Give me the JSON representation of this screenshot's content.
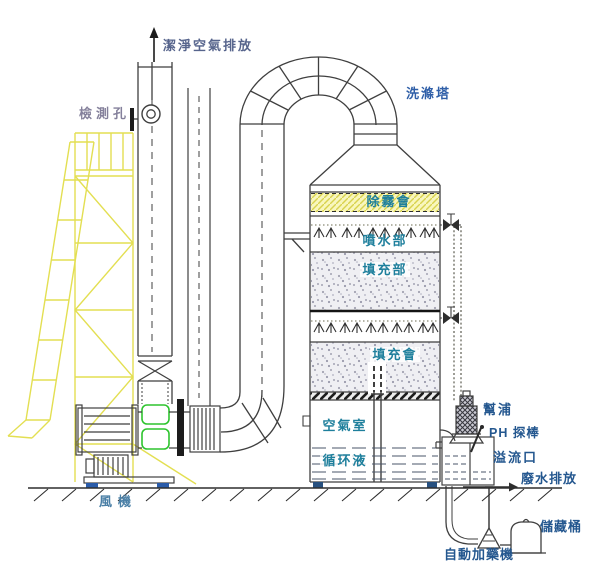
{
  "diagram": {
    "labels": {
      "clean_air": "潔淨空氣排放",
      "test_port": "檢測孔",
      "scrubber_tower": "洗滌塔",
      "demister": "除霧會",
      "spray_section": "噴水部",
      "packing_upper": "填充部",
      "packing_lower": "填充會",
      "air_chamber": "空氣室",
      "circulating_liquid": "循环液",
      "pump": "幫浦",
      "ph_probe": "PH 探棒",
      "overflow": "溢流口",
      "wastewater": "廢水排放",
      "storage_tank": "儲藏桶",
      "auto_doser": "自動加藥機",
      "fan": "風機"
    },
    "icons": {
      "clean_air_flow": "up-arrow",
      "spray_nozzles": "spray-arrow-row",
      "valves": "bowtie-valve"
    },
    "palette": {
      "label_teal": "#1e7f9c",
      "label_navy": "#24578f",
      "label_slate": "#56648c",
      "label_light": "#84809b",
      "label_midblue": "#2f5fa8",
      "scaffold_yellow": "#e3df52",
      "demister_yellow": "#f8f6bd",
      "flex_green": "#2ec42e",
      "mount_blue": "#2a5caa",
      "line_dark": "#3f3f3f"
    }
  }
}
